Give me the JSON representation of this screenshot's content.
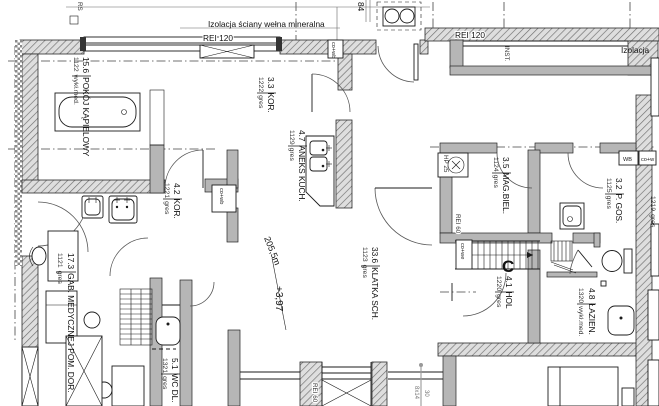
{
  "notes": {
    "insulation_top": "Izolacja ściany wełna mineralna",
    "insulation_right": "Izolacja",
    "inst_shaft": "INST.",
    "rs_mark": "RS",
    "dim_84": "84",
    "rei_120_left": "REI 120",
    "rei_120_right": "REI 120",
    "rei_60_wall": "REI 60",
    "rei_60_lift": "REI 60",
    "hp_25": "HP 25",
    "level_mark": "+3,97",
    "slope_mark": "205,5m",
    "stair_letter": "C",
    "stair_dim_a": "8x14",
    "stair_dim_b": "30"
  },
  "shafts": {
    "kitchen": "co+wb",
    "top": "co+wb",
    "stairs": "co+we",
    "wb": "WB",
    "right": "co+w"
  },
  "rooms": [
    {
      "area": "15.6",
      "name": "POKÓJ KĄPIELOWY",
      "code": "1122",
      "floor": "wykł.med."
    },
    {
      "area": "4.2",
      "name": "KOR.",
      "code": "1221",
      "floor": "gres"
    },
    {
      "area": "3.3",
      "name": "KOR.",
      "code": "1222",
      "floor": "gres"
    },
    {
      "area": "4.7",
      "name": "ANEKS KUCH.",
      "code": "1129",
      "floor": "gres"
    },
    {
      "area": "33.6",
      "name": "KLATKA SCH.",
      "code": "1123",
      "floor": "gres"
    },
    {
      "area": "3.5",
      "name": "MAG.BIEL.",
      "code": "1124",
      "floor": "gres"
    },
    {
      "area": "3.2",
      "name": "P. GOS.",
      "code": "1125",
      "floor": "gres"
    },
    {
      "area": "4.1",
      "name": "HOL",
      "code": "1220",
      "floor": "gres"
    },
    {
      "area": "4.8",
      "name": "ŁAZIEN.",
      "code": "1320",
      "floor": "wykł.med."
    },
    {
      "area": "17.3",
      "name": "GAB. MEDYCZNEJ POM. DOR.",
      "code": "1121",
      "floor": "gres"
    },
    {
      "area": "5.1",
      "name": "WC DL.",
      "code": "1321",
      "floor": "gres"
    },
    {
      "area": "",
      "name": "",
      "code": "1219",
      "floor": "gres"
    }
  ]
}
